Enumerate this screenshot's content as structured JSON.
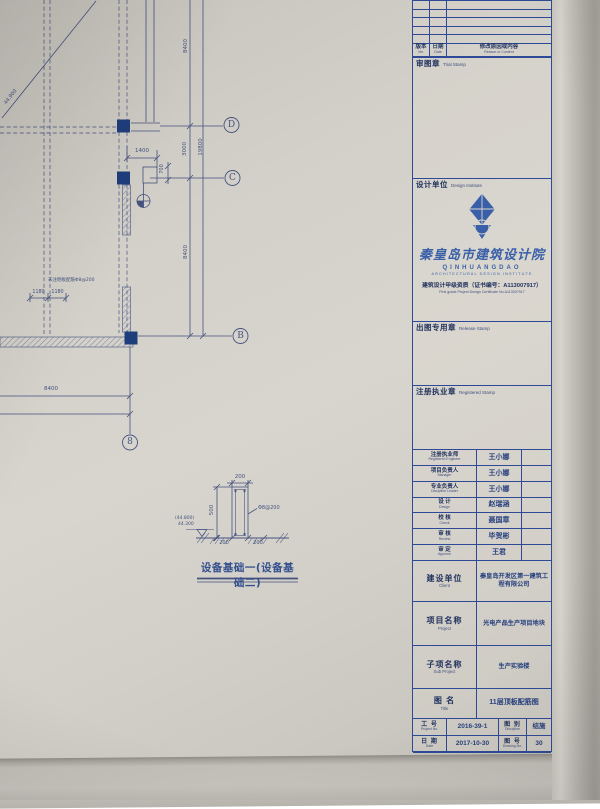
{
  "colors": {
    "paper": "#d3d0c9",
    "plan_ink": "#45527e",
    "title_line": "#2e4a96",
    "logo_blue": "#3a5fa9",
    "column_fill": "#1e3d7b"
  },
  "plan": {
    "diag_elev": "44.900",
    "dim_8400_top": "8400",
    "dim_1400": "1400",
    "dim_700": "700",
    "dim_3000": "3000",
    "dim_19800": "19800",
    "dim_8400_mid": "8400",
    "dim_8400_bottom": "8400",
    "note_small": "未注明板配筋Φ8@200",
    "dim_1180_a": "1180",
    "dim_1180_b": "1180",
    "grid_d": "D",
    "grid_c": "C",
    "grid_b": "B",
    "grid_8": "8"
  },
  "detail": {
    "dim_top": "200",
    "dim_height": "500",
    "rebar": "Φ8@200",
    "elev_top": "(44.800)",
    "elev_bottom": "44.300",
    "dim_left": "200",
    "dim_right": "200",
    "caption": "设备基础一(设备基础二)"
  },
  "titleblock": {
    "rev_header": {
      "ver_cn": "版本",
      "ver_en": "Ver.",
      "date_cn": "日期",
      "date_en": "Date",
      "content_cn": "修改原因或内容",
      "content_en": "Reason or Content"
    },
    "trial_stamp": {
      "cn": "审图章",
      "en": "Trial Stamp"
    },
    "design_institute": {
      "label_cn": "设计单位",
      "label_en": "Design Institute",
      "company_calligraphy": "秦皇岛市建筑设计院",
      "company_en": "QINHUANGDAO",
      "company_en2": "ARCHITECTURAL DESIGN INSTITUTE",
      "cert_cn": "建筑设计甲级资质（证书编号：A113007917）",
      "cert_en": "First grade Project Design Certificate No.A113007917"
    },
    "release_stamp": {
      "cn": "出图专用章",
      "en": "Release Stamp"
    },
    "registered_stamp": {
      "cn": "注册执业章",
      "en": "Registered Stamp"
    },
    "signers": [
      {
        "cn": "注册执业师",
        "en": "Registered Engineer",
        "name": "王小娜"
      },
      {
        "cn": "项目负责人",
        "en": "Manager",
        "name": "王小娜"
      },
      {
        "cn": "专业负责人",
        "en": "Discipline Leader",
        "name": "王小娜"
      },
      {
        "cn": "设 计",
        "en": "Design",
        "name": "赵瑞涵"
      },
      {
        "cn": "校 核",
        "en": "Check",
        "name": "聂国章"
      },
      {
        "cn": "审 核",
        "en": "Review",
        "name": "毕贺彬"
      },
      {
        "cn": "审 定",
        "en": "Approve",
        "name": "王君"
      }
    ],
    "client": {
      "cn": "建设单位",
      "en": "Client",
      "value": "秦皇岛开发区第一建筑工程有限公司"
    },
    "project": {
      "cn": "项目名称",
      "en": "Project",
      "value": "光电产品生产项目地块"
    },
    "subproject": {
      "cn": "子项名称",
      "en": "Sub Project",
      "value": "生产实验楼"
    },
    "sheet_title": {
      "cn": "图 名",
      "en": "Title",
      "value": "11层顶板配筋图"
    },
    "meta": [
      {
        "cn": "工 号",
        "en": "Project No.",
        "value": "2016-39-1",
        "cn2": "图 别",
        "en2": "Discipline",
        "value2": "结施"
      },
      {
        "cn": "日 期",
        "en": "Date",
        "value": "2017-10-30",
        "cn2": "图 号",
        "en2": "Drawing No.",
        "value2": "30"
      }
    ]
  }
}
